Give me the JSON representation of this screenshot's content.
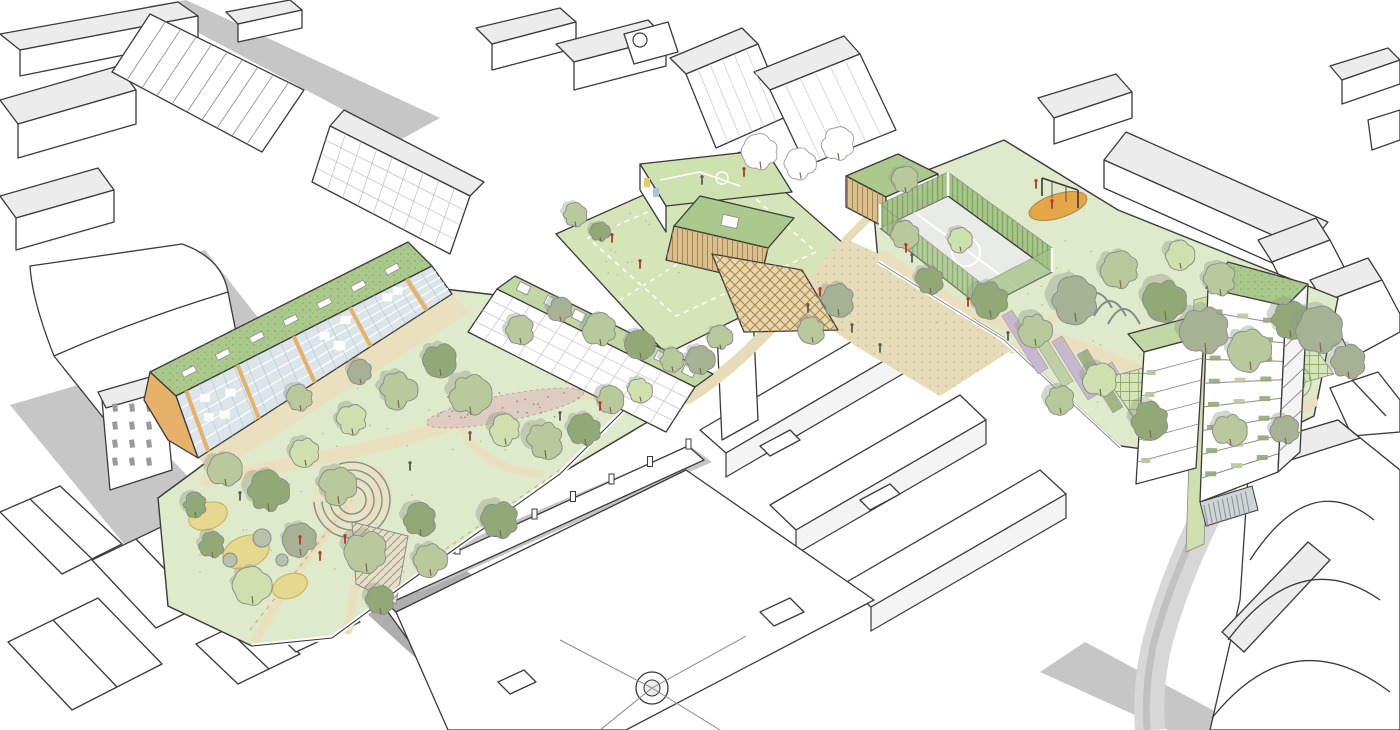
{
  "scene": {
    "kind": "architectural-masterplan-aerial-sketch",
    "description": "Hand-drawn aerial illustration of an urban regeneration masterplan: a linear green park with play areas and an amphitheatre, a mid-rise residential block with sedum roof, terrace housing, a school with rooftop play deck and sports pitch, timber community pavilion, multi-use games court, playground, community gardens with pergola, and a planted residential tower, all set within white line-drawn context streets and blocks.",
    "elements": [
      "context-buildings",
      "streets",
      "central-park",
      "natural-play-area",
      "amphitheatre",
      "residential-block",
      "terrace-housing",
      "school-building",
      "rooftop-play-deck",
      "sports-pitch",
      "timber-pavilion",
      "games-court",
      "playground",
      "community-gardens",
      "pergola",
      "planted-tower",
      "trees",
      "people-figures"
    ]
  },
  "palette": {
    "line": "#3a3a3a",
    "lineLight": "#8a8a8a",
    "white": "#ffffff",
    "ctxRoof": "#ececec",
    "ctxFace": "#f4f4f4",
    "shadow": "#c6c6c6",
    "shadowDark": "#aeaeae",
    "road": "#d7d7d7",
    "lawn": "#dfeacb",
    "lawnBright": "#d5e5b8",
    "pathTan": "#eadfbe",
    "plaza": "#e6dcba",
    "pathDot": "#b79f6e",
    "greenRoof": "#abc98c",
    "greenRoofLight": "#c3d7a5",
    "deckGreen": "#cde2b0",
    "treeSage": "#b9c99c",
    "treeOlive": "#93a877",
    "treeLight": "#cfdfae",
    "treeGray": "#a7b295",
    "treeShadow": "#8e9b82",
    "trunk": "#7a6a52",
    "timber": "#d9c08e",
    "timberDark": "#a8844f",
    "latticeFill": "#e8d7ac",
    "glass": "#dce6ea",
    "accentOrange": "#e6b26a",
    "playOrange": "#e5a647",
    "sand": "#e6d88f",
    "sandEdge": "#c8b766",
    "boulder": "#b9c1ad",
    "greenWall": "#a3c183",
    "greenWallLine": "#6f9a4f",
    "purple": "#c1aed0",
    "rainGarden": "#dcc8c2",
    "rainGardenEdge": "#b49a92",
    "figRed": "#b5362a",
    "figDark": "#5a5a5a",
    "hatchLine": "#9a9a8a",
    "crossLine": "#86a064",
    "desire": "#c9b89a",
    "baseSlat": "#cfd4d6"
  }
}
